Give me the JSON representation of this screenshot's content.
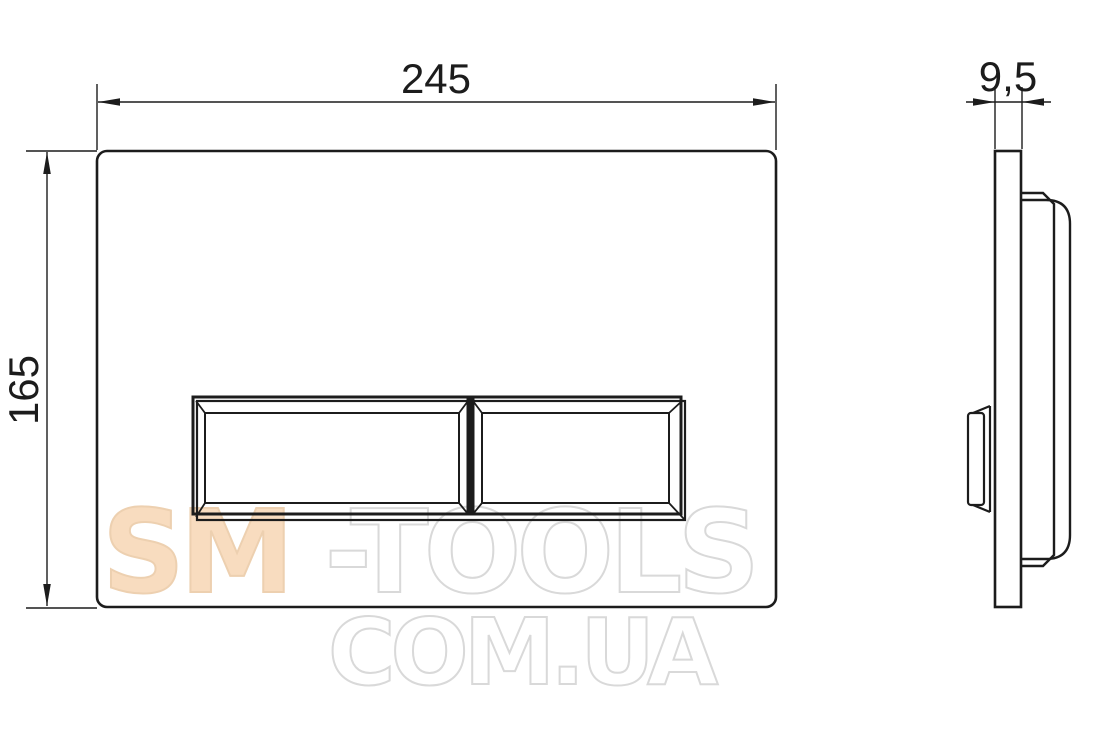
{
  "drawing": {
    "type": "technical-drawing",
    "subject": "toilet flush plate, front and side orthographic views",
    "background": "#ffffff",
    "line_color": "#1c1c1c",
    "views": {
      "front_view": "plate with two rectangular flush buttons",
      "side_view": "plate edge profile with button bump and mounting frame"
    },
    "dimensions": {
      "width_label": "245",
      "height_label": "165",
      "depth_label": "9,5"
    },
    "watermark": {
      "line1_accent": "SM",
      "line1_rest": "-TOOLS",
      "line2": "COM.UA",
      "accent_fill": "#f8dcbf",
      "accent_stroke": "#edd0b0",
      "outline_color": "#d9d9d9"
    }
  }
}
